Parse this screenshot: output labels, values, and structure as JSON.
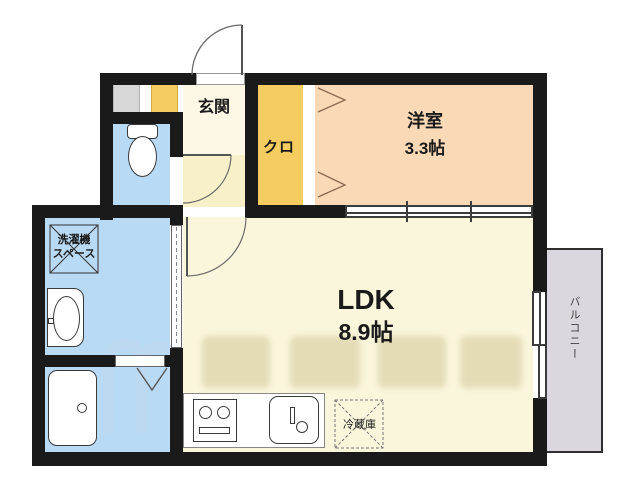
{
  "rooms": {
    "genkan": {
      "label": "玄関"
    },
    "closet": {
      "label": "クロ"
    },
    "western": {
      "label": "洋室",
      "size": "3.3帖"
    },
    "ldk": {
      "label": "LDK",
      "size": "8.9帖"
    },
    "balcony": {
      "label": "バルコニー"
    }
  },
  "fixtures": {
    "washer_space": {
      "line1": "洗濯機",
      "line2": "スペース"
    },
    "fridge": {
      "label": "冷蔵庫"
    }
  },
  "colors": {
    "wall": "#1a1a1a",
    "water_blue": "#b9daf4",
    "ldk_cream": "#faf6dc",
    "genkan_cream": "#fcf8e5",
    "hall_yellow": "#f7f0c8",
    "closet_orange": "#f5cc5f",
    "western_peach": "#fad9b6",
    "balcony_gray": "#dbd7df",
    "shaft_gray": "#d7d7d7",
    "watermark_blue": "#bfd9f0"
  }
}
